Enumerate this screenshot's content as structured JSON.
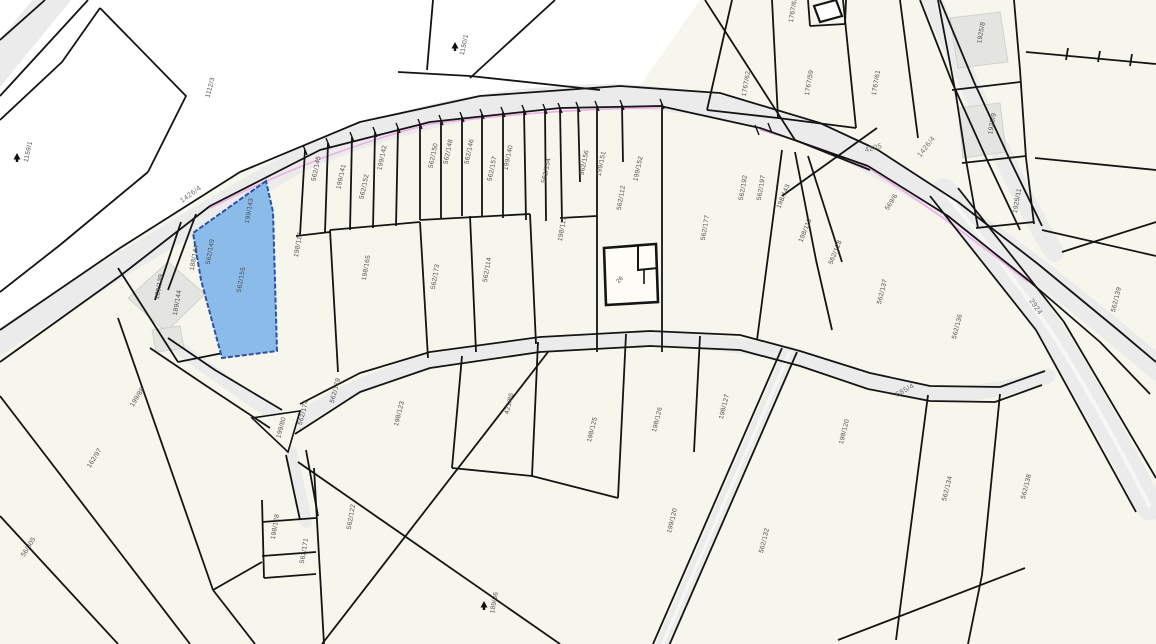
{
  "app": {
    "title": "Cadastral parcel map"
  },
  "colors": {
    "background": "#ffffff",
    "parcel_fill": "#f7f6ec",
    "road_fill": "#ebebeb",
    "boundary": "#141414",
    "selected_fill": "#8bbce9",
    "selected_stroke": "#2b51a3",
    "label_text": "#4b4b4b",
    "road_label_text": "#6e6e6e",
    "building_gray": "#e4e4e0",
    "magenta_accent": "#f0aee6"
  },
  "map": {
    "selected_parcel": {
      "id": "562/155"
    },
    "parcel_labels": [
      {
        "text": "1159/1",
        "x": 30,
        "y": 152,
        "r": -78
      },
      {
        "text": "1112/3",
        "x": 212,
        "y": 88,
        "r": -75
      },
      {
        "text": "1150/1",
        "x": 466,
        "y": 45,
        "r": -78
      },
      {
        "text": "199/143",
        "x": 251,
        "y": 211,
        "r": -80
      },
      {
        "text": "188/144",
        "x": 196,
        "y": 258,
        "r": -80
      },
      {
        "text": "562/149",
        "x": 212,
        "y": 252,
        "r": -80
      },
      {
        "text": "562/155",
        "x": 243,
        "y": 280,
        "r": -80
      },
      {
        "text": "189/139",
        "x": 161,
        "y": 287,
        "r": -80
      },
      {
        "text": "189/144",
        "x": 179,
        "y": 303,
        "r": -80
      },
      {
        "text": "198/117",
        "x": 300,
        "y": 245,
        "r": -80
      },
      {
        "text": "562/145",
        "x": 318,
        "y": 169,
        "r": -78
      },
      {
        "text": "199/141",
        "x": 343,
        "y": 177,
        "r": -78
      },
      {
        "text": "562/152",
        "x": 366,
        "y": 187,
        "r": -78
      },
      {
        "text": "199/142",
        "x": 384,
        "y": 158,
        "r": -78
      },
      {
        "text": "562/150",
        "x": 435,
        "y": 156,
        "r": -78
      },
      {
        "text": "562/148",
        "x": 450,
        "y": 152,
        "r": -78
      },
      {
        "text": "562/146",
        "x": 471,
        "y": 152,
        "r": -78
      },
      {
        "text": "562/157",
        "x": 494,
        "y": 169,
        "r": -78
      },
      {
        "text": "199/140",
        "x": 510,
        "y": 158,
        "r": -78
      },
      {
        "text": "562/154",
        "x": 548,
        "y": 171,
        "r": -78
      },
      {
        "text": "562/156",
        "x": 586,
        "y": 163,
        "r": -78
      },
      {
        "text": "199/151",
        "x": 603,
        "y": 164,
        "r": -78
      },
      {
        "text": "199/152",
        "x": 640,
        "y": 169,
        "r": -78
      },
      {
        "text": "562/112",
        "x": 623,
        "y": 198,
        "r": -80
      },
      {
        "text": "198/113",
        "x": 564,
        "y": 229,
        "r": -80
      },
      {
        "text": "198/165",
        "x": 368,
        "y": 268,
        "r": -80
      },
      {
        "text": "562/173",
        "x": 437,
        "y": 277,
        "r": -80
      },
      {
        "text": "562/114",
        "x": 489,
        "y": 270,
        "r": -80
      },
      {
        "text": "562/177",
        "x": 707,
        "y": 228,
        "r": -80
      },
      {
        "text": "562/192",
        "x": 745,
        "y": 188,
        "r": -80
      },
      {
        "text": "562/197",
        "x": 763,
        "y": 188,
        "r": -80
      },
      {
        "text": "198/143",
        "x": 785,
        "y": 197,
        "r": -68
      },
      {
        "text": "198/110",
        "x": 807,
        "y": 231,
        "r": -68
      },
      {
        "text": "562/128",
        "x": 837,
        "y": 253,
        "r": -68
      },
      {
        "text": "569/6",
        "x": 893,
        "y": 203,
        "r": -58
      },
      {
        "text": "562/137",
        "x": 884,
        "y": 292,
        "r": -76
      },
      {
        "text": "562/136",
        "x": 959,
        "y": 327,
        "r": -76
      },
      {
        "text": "1767/62",
        "x": 748,
        "y": 84,
        "r": -80
      },
      {
        "text": "1767/59",
        "x": 811,
        "y": 83,
        "r": -80
      },
      {
        "text": "1767/61",
        "x": 878,
        "y": 83,
        "r": -80
      },
      {
        "text": "1767/63",
        "x": 795,
        "y": 10,
        "r": -80
      },
      {
        "text": "1925/8",
        "x": 983,
        "y": 33,
        "r": -80
      },
      {
        "text": "1925/9",
        "x": 994,
        "y": 124,
        "r": -80
      },
      {
        "text": "1925/11",
        "x": 1019,
        "y": 201,
        "r": -80
      },
      {
        "text": "562/139",
        "x": 1118,
        "y": 300,
        "r": -76
      },
      {
        "text": "562/179",
        "x": 337,
        "y": 391,
        "r": -75
      },
      {
        "text": "562/174",
        "x": 305,
        "y": 413,
        "r": -75
      },
      {
        "text": "199/80",
        "x": 283,
        "y": 428,
        "r": -75
      },
      {
        "text": "198/123",
        "x": 401,
        "y": 414,
        "r": -76
      },
      {
        "text": "421/86",
        "x": 511,
        "y": 404,
        "r": -76
      },
      {
        "text": "198/125",
        "x": 594,
        "y": 430,
        "r": -76
      },
      {
        "text": "198/126",
        "x": 659,
        "y": 420,
        "r": -76
      },
      {
        "text": "198/127",
        "x": 726,
        "y": 407,
        "r": -76
      },
      {
        "text": "198/120",
        "x": 846,
        "y": 432,
        "r": -76
      },
      {
        "text": "199/120",
        "x": 674,
        "y": 521,
        "r": -76
      },
      {
        "text": "562/132",
        "x": 766,
        "y": 541,
        "r": -76
      },
      {
        "text": "562/134",
        "x": 949,
        "y": 489,
        "r": -76
      },
      {
        "text": "562/138",
        "x": 1028,
        "y": 487,
        "r": -76
      },
      {
        "text": "199/88",
        "x": 139,
        "y": 398,
        "r": -58
      },
      {
        "text": "162/97",
        "x": 96,
        "y": 459,
        "r": -58
      },
      {
        "text": "56/305",
        "x": 30,
        "y": 548,
        "r": -58
      },
      {
        "text": "198/128",
        "x": 277,
        "y": 527,
        "r": -80
      },
      {
        "text": "562/171",
        "x": 306,
        "y": 551,
        "r": -80
      },
      {
        "text": "562/122",
        "x": 353,
        "y": 517,
        "r": -80
      },
      {
        "text": "189/36",
        "x": 496,
        "y": 603,
        "r": -80
      }
    ],
    "road_labels": [
      {
        "text": "1426/4",
        "x": 192,
        "y": 196,
        "r": -36
      },
      {
        "text": "4205",
        "x": 874,
        "y": 150,
        "r": -14
      },
      {
        "text": "1426/4",
        "x": 928,
        "y": 148,
        "r": -52
      },
      {
        "text": "2924",
        "x": 1034,
        "y": 308,
        "r": 55
      },
      {
        "text": "585/4",
        "x": 906,
        "y": 392,
        "r": -30
      }
    ],
    "building_labels": [
      {
        "text": "26",
        "x": 621,
        "y": 281,
        "r": -45
      }
    ],
    "tree_markers": [
      {
        "x": 17,
        "y": 158
      },
      {
        "x": 455,
        "y": 47
      },
      {
        "x": 484,
        "y": 606
      }
    ]
  }
}
